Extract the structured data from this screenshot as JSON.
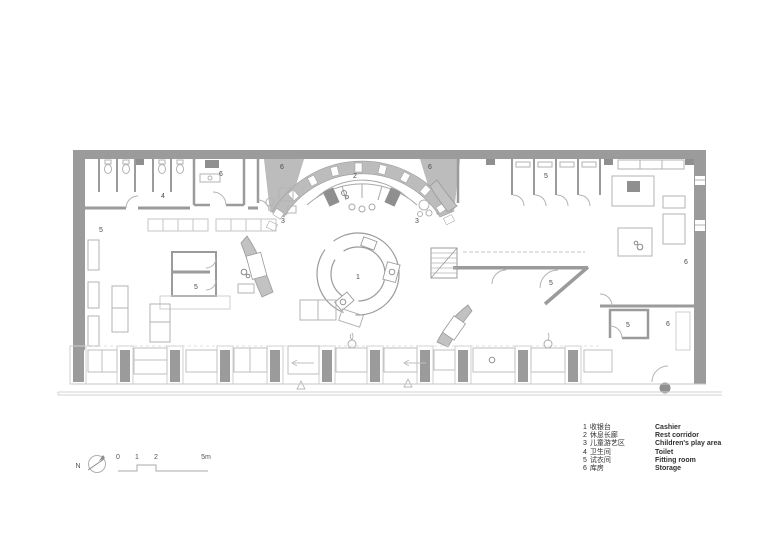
{
  "plan": {
    "room_labels": [
      {
        "text": "4",
        "x": 163,
        "y": 196
      },
      {
        "text": "6",
        "x": 221,
        "y": 174
      },
      {
        "text": "6",
        "x": 282,
        "y": 167
      },
      {
        "text": "2",
        "x": 355,
        "y": 176
      },
      {
        "text": "6",
        "x": 430,
        "y": 167
      },
      {
        "text": "3",
        "x": 283,
        "y": 221
      },
      {
        "text": "3",
        "x": 417,
        "y": 221
      },
      {
        "text": "5",
        "x": 101,
        "y": 230
      },
      {
        "text": "5",
        "x": 546,
        "y": 176
      },
      {
        "text": "1",
        "x": 358,
        "y": 277
      },
      {
        "text": "5",
        "x": 196,
        "y": 287
      },
      {
        "text": "5",
        "x": 551,
        "y": 283
      },
      {
        "text": "6",
        "x": 686,
        "y": 262
      },
      {
        "text": "5",
        "x": 628,
        "y": 325
      },
      {
        "text": "6",
        "x": 668,
        "y": 324
      }
    ]
  },
  "legend": {
    "items": [
      {
        "number": "1",
        "zh": "收银台",
        "en": "Cashier"
      },
      {
        "number": "2",
        "zh": "休息长廊",
        "en": "Rest corridor"
      },
      {
        "number": "3",
        "zh": "儿童游艺区",
        "en": "Children's play area"
      },
      {
        "number": "4",
        "zh": "卫生间",
        "en": "Toilet"
      },
      {
        "number": "5",
        "zh": "试衣间",
        "en": "Fitting room"
      },
      {
        "number": "6",
        "zh": "库房",
        "en": "Storage"
      }
    ]
  },
  "scale_bar": {
    "labels": [
      "0",
      "1",
      "2",
      "5m"
    ]
  },
  "north": {
    "label": "N"
  },
  "colors": {
    "wall": "#9b9b9b",
    "wall_dark": "#8f8f8f",
    "band": "#bcbcbc",
    "furniture": "#b3b3b3",
    "light": "#cfcfcf",
    "text": "#4a4a4a"
  }
}
